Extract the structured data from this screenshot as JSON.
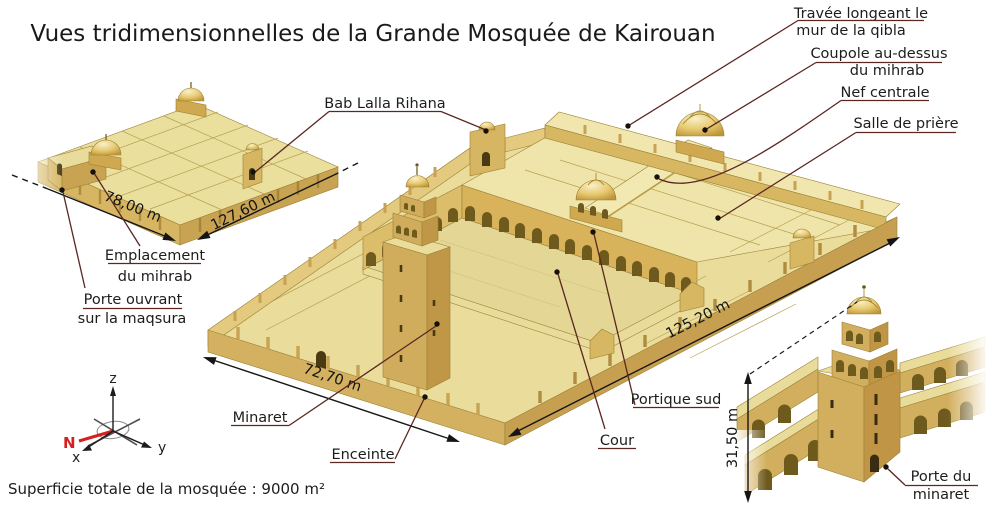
{
  "title": "Vues tridimensionnelles de la Grande Mosquée de Kairouan",
  "footer": "Superficie totale de la mosquée : 9000 m²",
  "labels": {
    "travee_line1": "Travée longeant le",
    "travee_line2": "mur de la qibla",
    "coupole_line1": "Coupole au-dessus",
    "coupole_line2": "du mihrab",
    "nef": "Nef centrale",
    "salle": "Salle de prière",
    "bab": "Bab Lalla Rihana",
    "emplacement_line1": "Emplacement",
    "emplacement_line2": "du mihrab",
    "maqsura_line1": "Porte ouvrant",
    "maqsura_line2": "sur la maqsura",
    "minaret": "Minaret",
    "enceinte": "Enceinte",
    "cour": "Cour",
    "portique": "Portique sud",
    "porte_minaret_line1": "Porte du",
    "porte_minaret_line2": "minaret"
  },
  "dimensions": {
    "small_view_width": "78,00 m",
    "small_view_length": "127,60 m",
    "main_view_width": "72,70 m",
    "main_view_length": "125,20 m",
    "minaret_height": "31,50 m"
  },
  "compass": {
    "axis_z": "z",
    "axis_y": "y",
    "axis_x": "x",
    "north": "N"
  },
  "colors": {
    "leader_line": "#5a2722",
    "north_red": "#d61f1f",
    "sand_light": "#ece09f",
    "sand_mid": "#d5b263",
    "sand_dark": "#c49c4e",
    "ink": "#1c1c1c"
  }
}
